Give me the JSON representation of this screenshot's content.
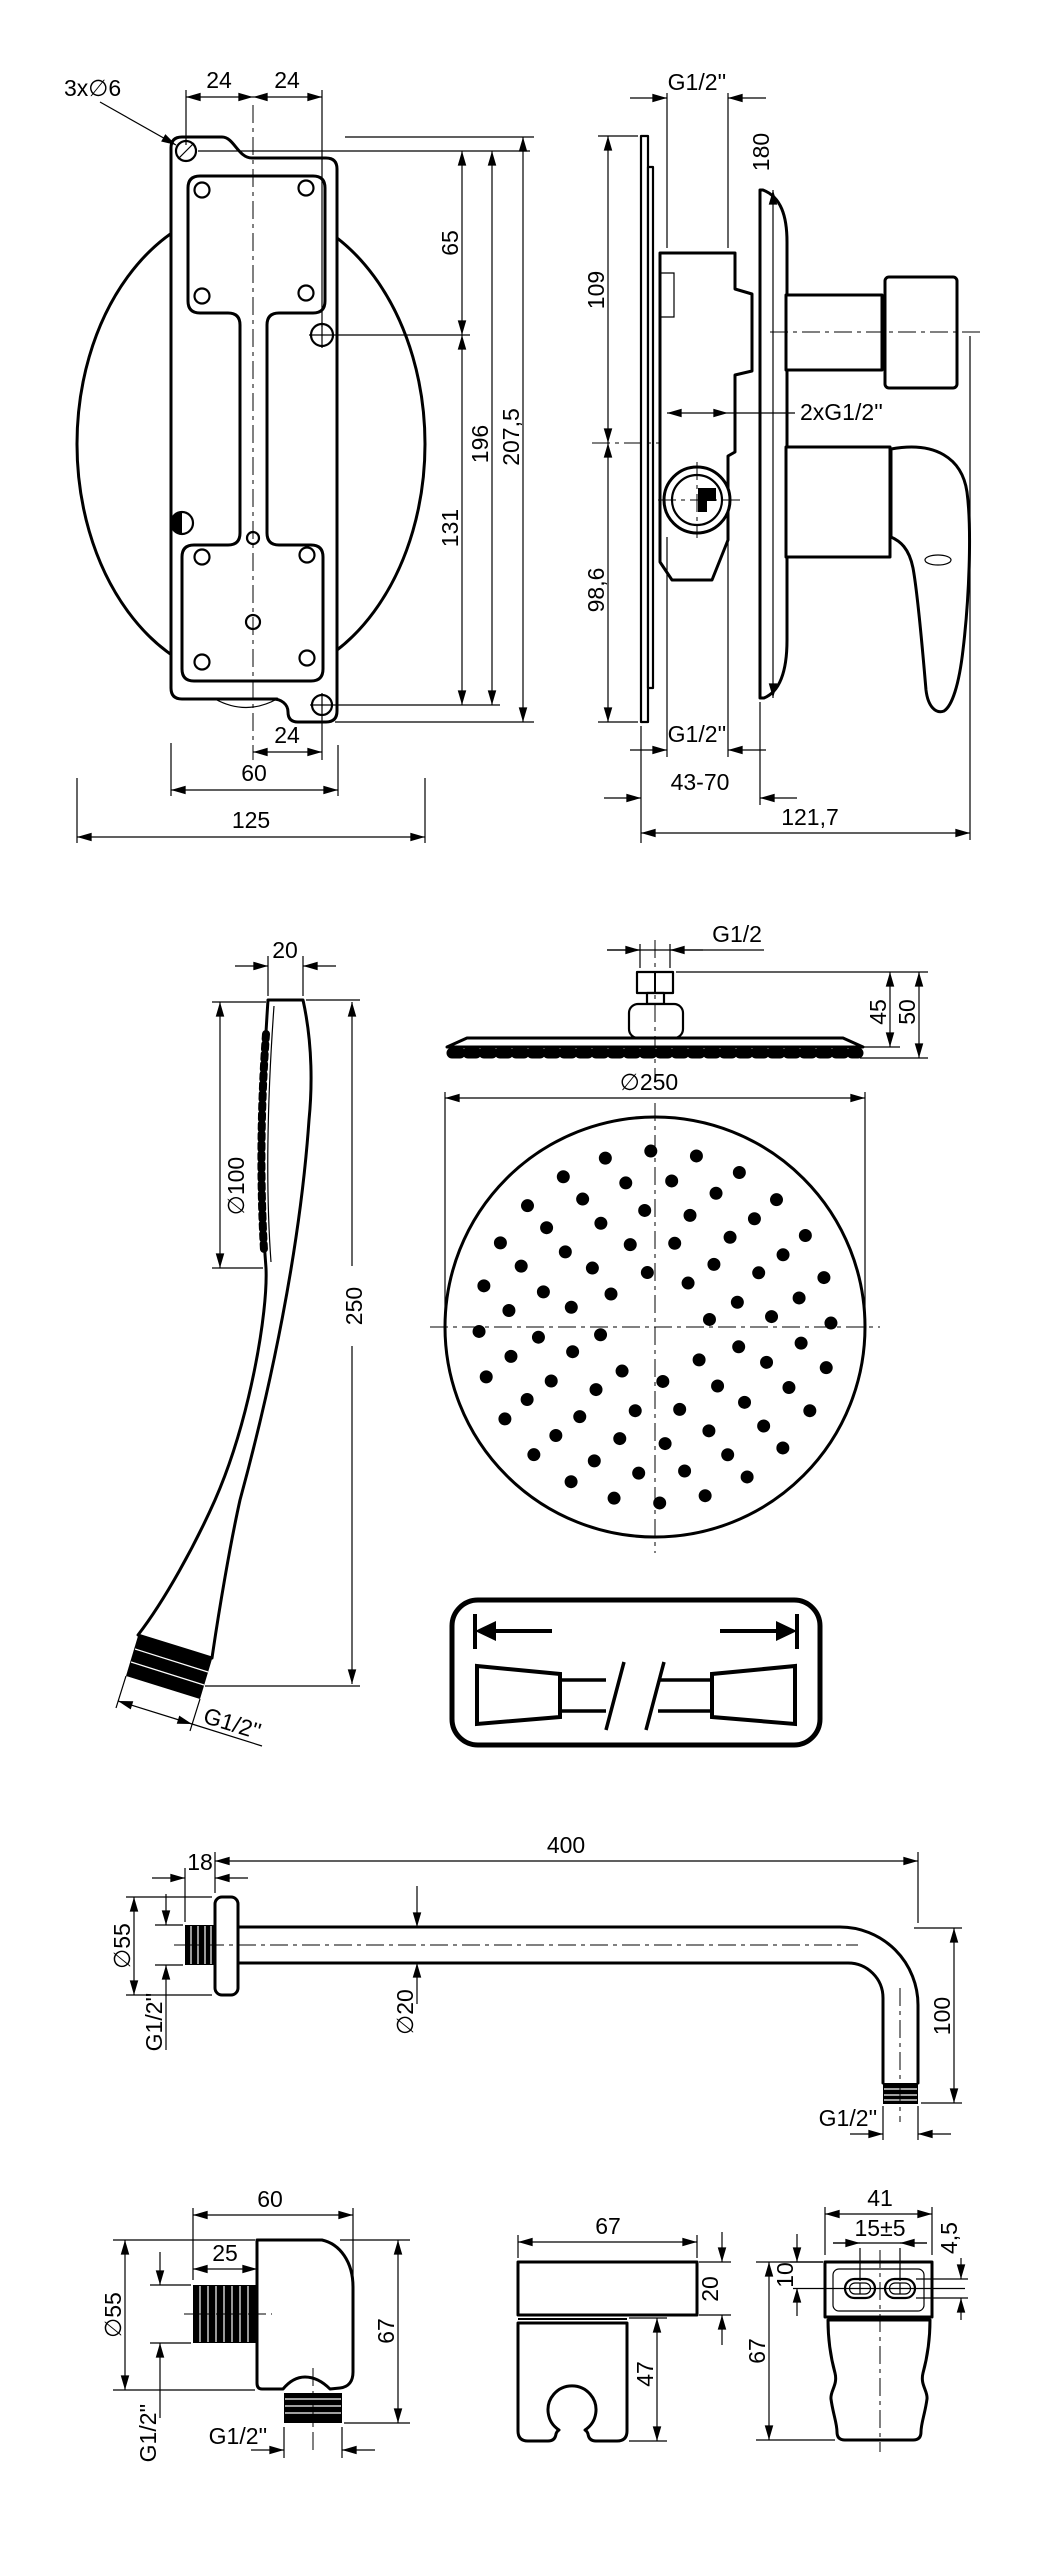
{
  "page": {
    "background": "#ffffff",
    "line_color": "#000000"
  },
  "views": {
    "mounting_plate": {
      "dims": {
        "holes": "3x∅6",
        "pitch_left": "24",
        "pitch_right": "24",
        "hole_upper": "65",
        "hole_lower": "131",
        "holes_span": "196",
        "total_height": "207,5",
        "bottom_pitch": "24",
        "plate_width": "60",
        "total_width": "125"
      }
    },
    "mixer": {
      "dims": {
        "top_thread": "G1/2''",
        "plate_diameter": "180",
        "upper_height": "109",
        "side_threads": "2xG1/2''",
        "lower_height": "98,6",
        "bottom_thread": "G1/2''",
        "depth_range": "43-70",
        "total_depth": "121,7"
      }
    },
    "hand_shower": {
      "dims": {
        "head_thickness": "20",
        "face_diameter": "∅100",
        "length": "250",
        "thread": "G1/2''"
      }
    },
    "head_side": {
      "dims": {
        "thread": "G1/2",
        "height_to_plate": "45",
        "height_total": "50"
      }
    },
    "head_face": {
      "dims": {
        "diameter": "∅250"
      }
    },
    "hose": {
      "length": "150 cm",
      "left_thread": "G1/2\"",
      "right_thread": "G1/2\""
    },
    "arm": {
      "dims": {
        "length": "400",
        "wall_thread_length": "18",
        "flange_diameter": "∅55",
        "wall_thread": "G1/2''",
        "pipe_diameter": "∅20",
        "drop": "100",
        "end_thread": "G1/2''"
      }
    },
    "outlet": {
      "dims": {
        "width": "60",
        "thread_length": "25",
        "flange_diameter": "∅55",
        "height": "67",
        "side_thread": "G1/2''",
        "bottom_thread": "G1/2''"
      }
    },
    "holder_side": {
      "dims": {
        "width": "67",
        "plate_thickness": "20",
        "fork_height": "47"
      }
    },
    "holder_back": {
      "dims": {
        "width": "41",
        "slot_spacing": "15±5",
        "slot_height": "4,5",
        "slot_offset": "10",
        "height": "67"
      }
    }
  }
}
